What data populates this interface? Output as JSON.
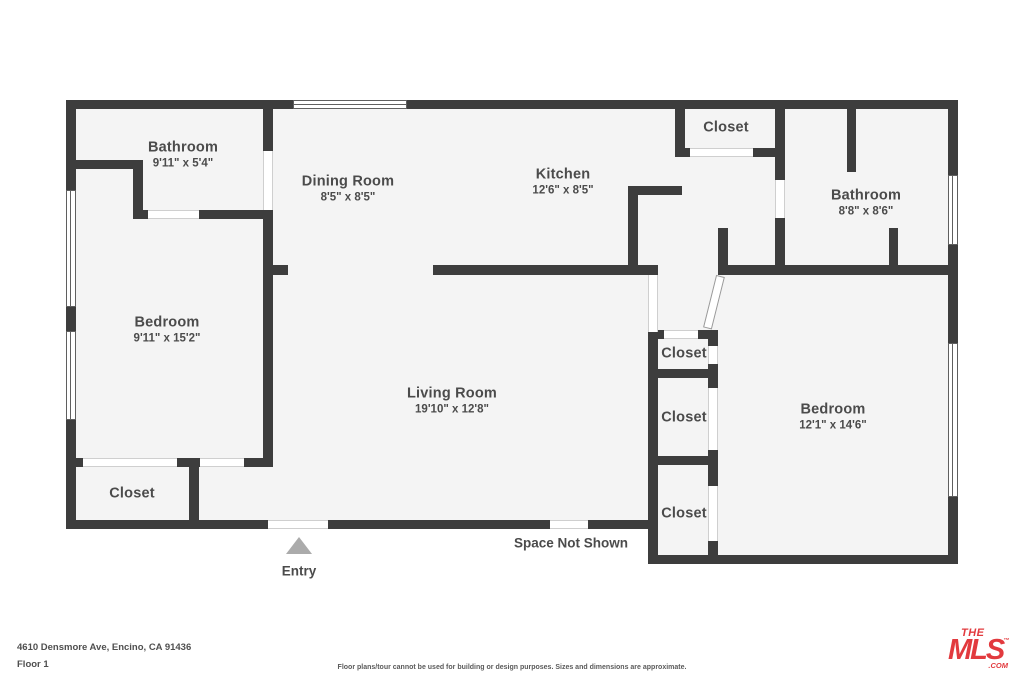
{
  "rooms": {
    "bathroom_upper": {
      "name": "Bathroom",
      "dims": "9'11\" x 5'4\""
    },
    "dining": {
      "name": "Dining Room",
      "dims": "8'5\" x 8'5\""
    },
    "kitchen": {
      "name": "Kitchen",
      "dims": "12'6\" x 8'5\""
    },
    "closet_top": {
      "name": "Closet"
    },
    "bathroom_right": {
      "name": "Bathroom",
      "dims": "8'8\" x 8'6\""
    },
    "bedroom_left": {
      "name": "Bedroom",
      "dims": "9'11\" x 15'2\""
    },
    "living": {
      "name": "Living Room",
      "dims": "19'10\" x 12'8\""
    },
    "closet_hall_1": {
      "name": "Closet"
    },
    "closet_hall_2": {
      "name": "Closet"
    },
    "closet_hall_3": {
      "name": "Closet"
    },
    "bedroom_right": {
      "name": "Bedroom",
      "dims": "12'1\" x 14'6\""
    },
    "closet_bottom_left": {
      "name": "Closet"
    }
  },
  "annotations": {
    "space_not_shown": "Space Not Shown",
    "entry": "Entry"
  },
  "footer": {
    "address": "4610 Densmore Ave, Encino, CA 91436",
    "floor": "Floor 1",
    "disclaimer": "Floor plans/tour cannot be used for building or design purposes. Sizes and dimensions are approximate."
  },
  "logo": {
    "the": "THE",
    "mls": "MLS",
    "tm": "™",
    "com": ".COM"
  },
  "colors": {
    "wall": "#3d3d3d",
    "floor": "#f4f4f4",
    "label_text": "#4b4b4b",
    "logo_red": "#e23a3e",
    "entry_arrow": "#ababab"
  }
}
